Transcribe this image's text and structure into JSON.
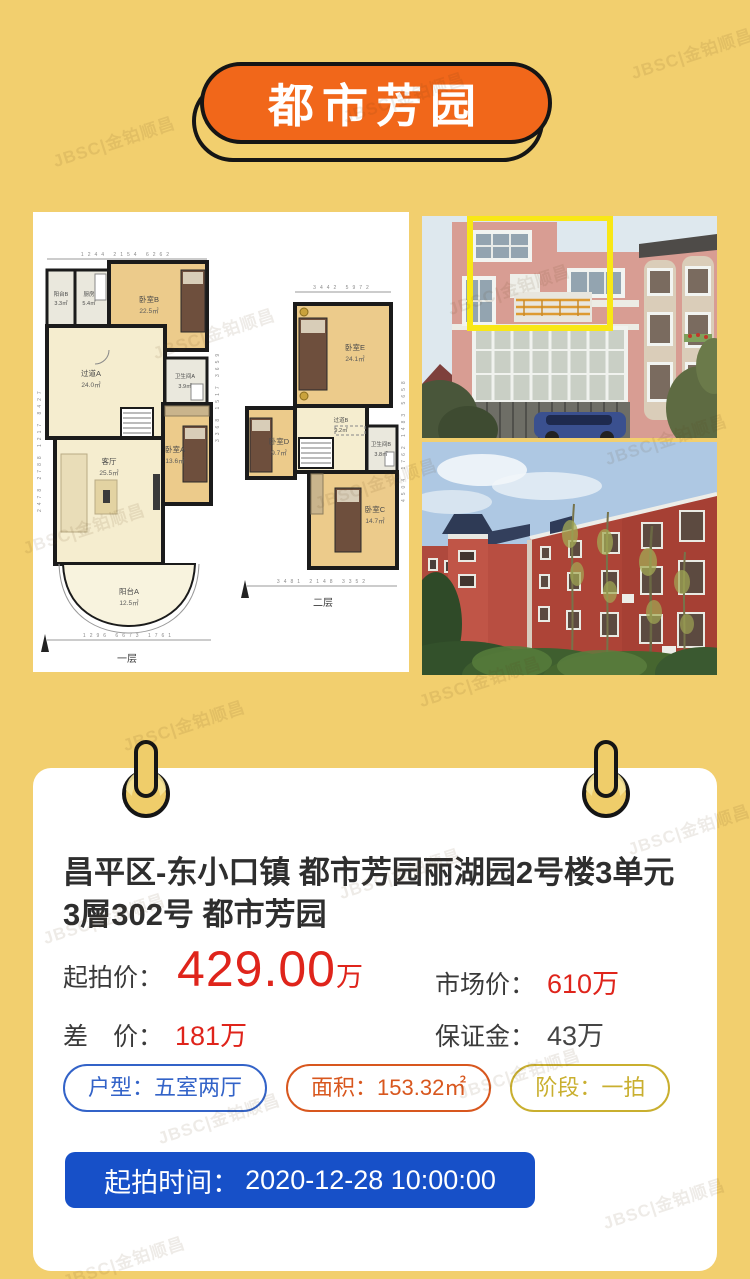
{
  "colors": {
    "background": "#F2CF6E",
    "banner_orange": "#F1671A",
    "outline_black": "#151515",
    "card_white": "#FFFFFF",
    "price_red": "#DF241B",
    "label_dark": "#3A3A3A",
    "tag_blue": "#3363C8",
    "tag_orange": "#D8571E",
    "tag_yellow": "#C9AF2F",
    "button_blue": "#1750C8",
    "photo_highlight_yellow": "#F8E716"
  },
  "watermark": {
    "text": "JBSC|金铂顺昌"
  },
  "banner": {
    "title": "都市芳园"
  },
  "floorplan": {
    "floor1": {
      "label": "一层",
      "dims_top": "1244   2154   6262",
      "dims_bottom": "1296   6673   1761",
      "dims_left": "2478  2788  1217  8427",
      "dims_right": "3368  1517  3659",
      "rooms": {
        "balcony_b": {
          "name": "阳台B",
          "area": "3.3㎡"
        },
        "kitchen": {
          "name": "厨房",
          "area": "5.4㎡"
        },
        "bedroom_b": {
          "name": "卧室B",
          "area": "22.5㎡"
        },
        "hallway_a": {
          "name": "过道A",
          "area": "24.0㎡"
        },
        "bath_a": {
          "name": "卫生间A",
          "area": "3.9㎡"
        },
        "living": {
          "name": "客厅",
          "area": "25.5㎡"
        },
        "bedroom_a": {
          "name": "卧室A",
          "area": "13.6㎡"
        },
        "balcony_a": {
          "name": "阳台A",
          "area": "12.5㎡"
        }
      }
    },
    "floor2": {
      "label": "二层",
      "dims_top": "3442   5972",
      "dims_bottom": "3481   2148   3352",
      "dims_right": "4504  1762  1483  5658",
      "rooms": {
        "bedroom_e": {
          "name": "卧室E",
          "area": "24.1㎡"
        },
        "bedroom_d": {
          "name": "卧室D",
          "area": "9.7㎡"
        },
        "hallway_b": {
          "name": "过道B",
          "area": "9.2㎡"
        },
        "bath_b": {
          "name": "卫生间B",
          "area": "3.8㎡"
        },
        "bedroom_c": {
          "name": "卧室C",
          "area": "14.7㎡"
        }
      }
    }
  },
  "card": {
    "title_line1": "昌平区-东小口镇 都市芳园丽湖园2号楼3单元",
    "title_line2": "3層302号 都市芳园",
    "start_price": {
      "label": "起拍价：",
      "value": "429.00",
      "unit": "万"
    },
    "market_price": {
      "label": "市场价：",
      "value": "610万"
    },
    "price_diff": {
      "label": "差　价：",
      "value": "181万"
    },
    "deposit": {
      "label": "保证金：",
      "value": "43万"
    },
    "tags": {
      "layout": "户型：五室两厅",
      "area": "面积：153.32㎡",
      "stage": "阶段：一拍"
    },
    "auction_time": {
      "label": "起拍时间：",
      "value": "2020-12-28 10:00:00"
    }
  }
}
